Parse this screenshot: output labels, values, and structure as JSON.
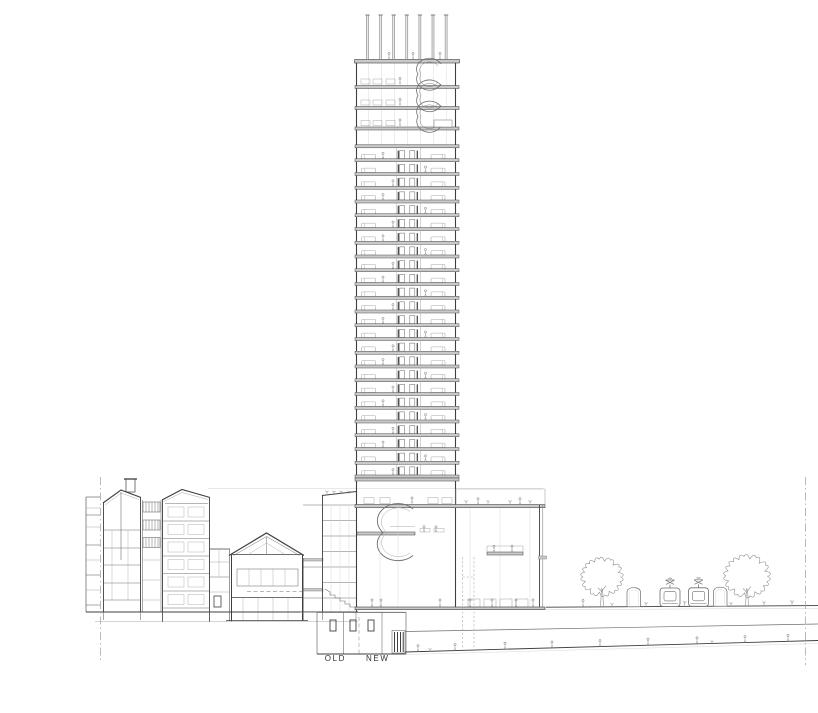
{
  "title": "High-rise tower section drawing, old town context",
  "labels": {
    "old": "OLD",
    "new": "NEW"
  },
  "colors": {
    "background": "#ffffff",
    "ink": "#3f3f3f",
    "mid": "#6e6e6e",
    "light": "#a8a8a8",
    "faint": "#d2d2d2",
    "slab_fill": "#c9c9c9",
    "column_fill": "#e9e9e9",
    "figure": "#8f8f8f",
    "label": "#333333"
  },
  "tower": {
    "left": 356.5,
    "right": 455.5,
    "typical_floor_count": 24,
    "floors_start_y": 148,
    "floor_height": 13.75,
    "pergola": {
      "column_count": 7,
      "first_x": 367.5,
      "spacing": 13.1,
      "top_y": 15,
      "bottom_y": 59.5
    },
    "upper_slab_ys": [
      85.5,
      106.5,
      127,
      144.8
    ],
    "upper_furniture_x": [
      361,
      373,
      386
    ],
    "core": {
      "left_x": 396.5,
      "right_x": 420.5
    }
  },
  "podium": {
    "counter_x": [
      468,
      484,
      500,
      516
    ],
    "desk_x": [
      364,
      380,
      428,
      442
    ],
    "roof_sprout_x": [
      466,
      488,
      510,
      530
    ],
    "roof_people_x": [
      478,
      520
    ]
  },
  "people": {
    "terrace_x": [
      389,
      413,
      440
    ],
    "podium_x": [
      372,
      381,
      440,
      470,
      492,
      516,
      533
    ],
    "bridge_x": [
      494,
      512
    ],
    "tower_mezz_x": [
      424,
      436
    ],
    "tunnel_x": [
      418,
      455,
      505,
      552,
      600,
      648,
      697,
      745,
      788
    ],
    "street_x": [
      583
    ]
  },
  "street": {
    "ground": {
      "x1": 546,
      "y1": 607.2,
      "x2": 818,
      "y2": 605.6
    },
    "trees": [
      {
        "x": 602,
        "r": 20
      },
      {
        "x": 747,
        "r": 22
      }
    ],
    "kiosks_x": [
      627,
      713.5
    ],
    "trams_x": [
      660,
      688.5
    ],
    "sprouts_x": [
      612,
      646,
      684.5,
      731,
      764,
      792
    ]
  },
  "tunnel": {
    "x1": 405,
    "top_y1": 631.5,
    "top_y2": 624,
    "floor_y1": 652,
    "floor_y2": 640.5,
    "x2": 818
  },
  "old_town": {
    "roof_plants_x": [
      327,
      334,
      341,
      349
    ]
  },
  "boundaries": {
    "left_x": 100.5,
    "right_x": 805.5,
    "divider_x": 359
  }
}
